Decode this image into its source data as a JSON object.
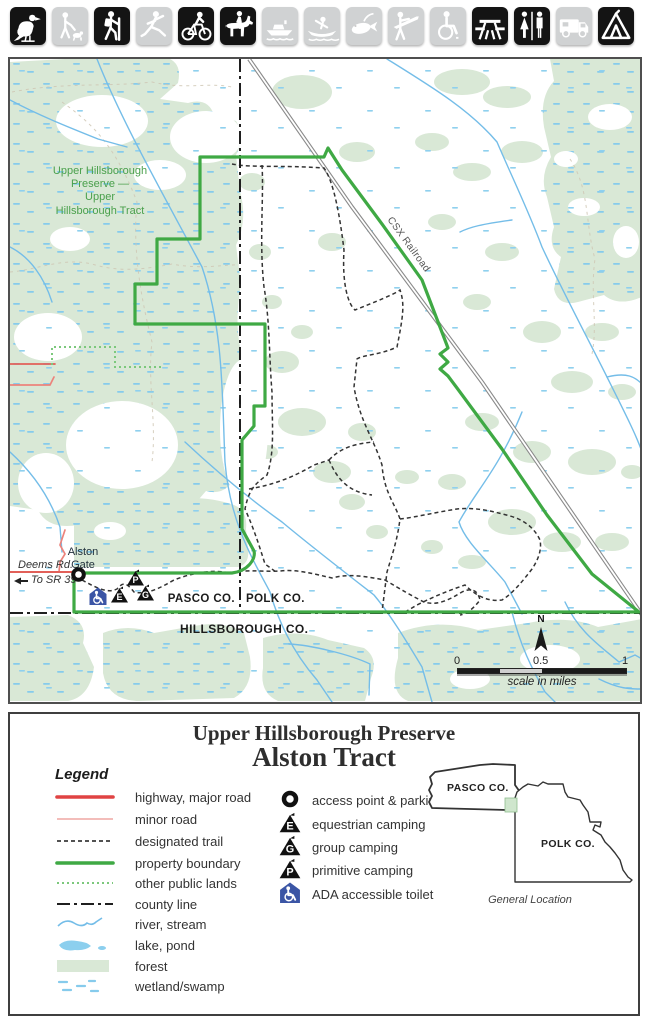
{
  "colors": {
    "forest": "#d9e8d6",
    "wetland_mark": "#86cbec",
    "stream": "#74bde8",
    "property_boundary": "#3fa944",
    "other_public_lands": "#7cc87c",
    "county_line": "#1f1f1f",
    "trail": "#333333",
    "highway": "#e04343",
    "minor_road": "#f3bdba",
    "railroad": "#8a8a8a",
    "ada_blue": "#3b55a5",
    "toolbar_active": "#141414",
    "toolbar_inactive": "#d0d2d3",
    "label_green": "#4aa04c"
  },
  "toolbar": {
    "icons": [
      {
        "name": "birdwatching",
        "active": true
      },
      {
        "name": "dog-walking",
        "active": false
      },
      {
        "name": "hiking",
        "active": true
      },
      {
        "name": "skating",
        "active": false
      },
      {
        "name": "bicycling",
        "active": true
      },
      {
        "name": "horseback-riding",
        "active": true
      },
      {
        "name": "motorboating",
        "active": false
      },
      {
        "name": "canoeing",
        "active": false
      },
      {
        "name": "fishing",
        "active": false
      },
      {
        "name": "hunting",
        "active": false
      },
      {
        "name": "wheelchair-access",
        "active": false
      },
      {
        "name": "picnicking",
        "active": true
      },
      {
        "name": "restrooms",
        "active": true
      },
      {
        "name": "rv-camping",
        "active": false
      },
      {
        "name": "tent-camping",
        "active": true
      }
    ]
  },
  "map": {
    "preserve_label": "Upper Hillsborough\nPreserve —\nUpper\nHillsborough Tract",
    "railroad_label": "CSX Railroad",
    "pasco": "PASCO CO.",
    "polk": "POLK CO.",
    "hillsborough": "HILLSBOROUGH CO.",
    "alston_gate": "Alston\nGate",
    "deems_rd": "Deems Rd.",
    "to_sr": "To SR 39",
    "north": "N",
    "scale": {
      "t0": "0",
      "t05": "0.5",
      "t1": "1",
      "caption": "scale in miles"
    },
    "camps": {
      "primitive": "P",
      "equestrian": "E",
      "group": "G"
    }
  },
  "legend": {
    "title1": "Upper Hillsborough Preserve",
    "title2": "Alston Tract",
    "heading": "Legend",
    "line_items": [
      {
        "swatch": "highway",
        "label": "highway, major road"
      },
      {
        "swatch": "minor-road",
        "label": "minor road"
      },
      {
        "swatch": "trail",
        "label": "designated trail"
      },
      {
        "swatch": "boundary",
        "label": "property boundary"
      },
      {
        "swatch": "public-lands",
        "label": "other public lands"
      },
      {
        "swatch": "county-line",
        "label": "county line"
      },
      {
        "swatch": "river",
        "label": "river, stream"
      },
      {
        "swatch": "lake",
        "label": "lake, pond"
      },
      {
        "swatch": "forest",
        "label": "forest"
      },
      {
        "swatch": "wetland",
        "label": "wetland/swamp"
      }
    ],
    "point_items": [
      {
        "icon": "access-point",
        "label": "access point & parking"
      },
      {
        "icon": "tent",
        "letter": "E",
        "label": "equestrian camping"
      },
      {
        "icon": "tent",
        "letter": "G",
        "label": "group camping"
      },
      {
        "icon": "tent",
        "letter": "P",
        "label": "primitive camping"
      },
      {
        "icon": "ada-toilet",
        "label": "ADA accessible toilet"
      }
    ],
    "inset": {
      "pasco": "PASCO CO.",
      "polk": "POLK CO.",
      "caption": "General Location"
    }
  }
}
